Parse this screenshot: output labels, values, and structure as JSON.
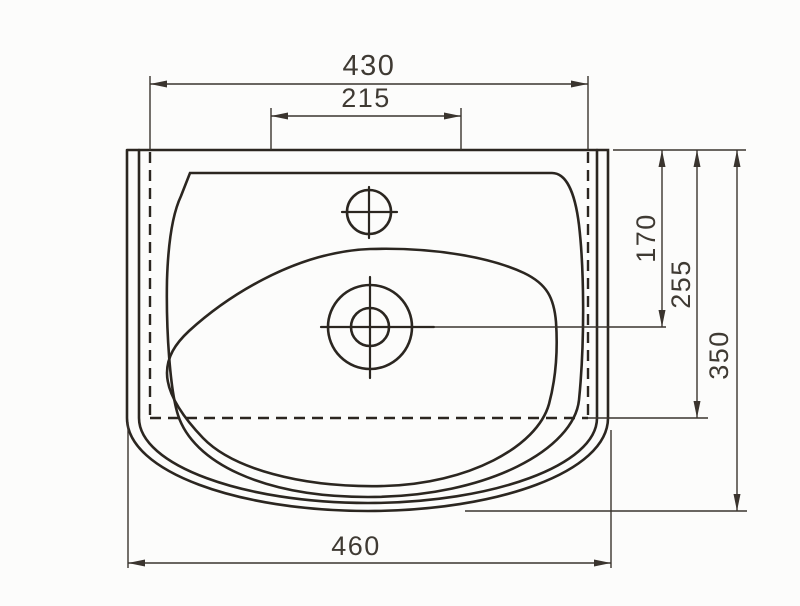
{
  "drawing": {
    "type": "technical-dimension-drawing",
    "subject": "washbasin-top-view",
    "unit": "mm",
    "dimensions": {
      "top_width": "430",
      "tap_ledge_width": "215",
      "overall_width": "460",
      "front_to_drain": "170",
      "front_to_basin_back": "255",
      "overall_depth": "350"
    },
    "colors": {
      "object_line": "#2b2620",
      "dimension_line": "#3a342e",
      "text": "#3f3a33",
      "background": "#fcfcfb"
    }
  }
}
